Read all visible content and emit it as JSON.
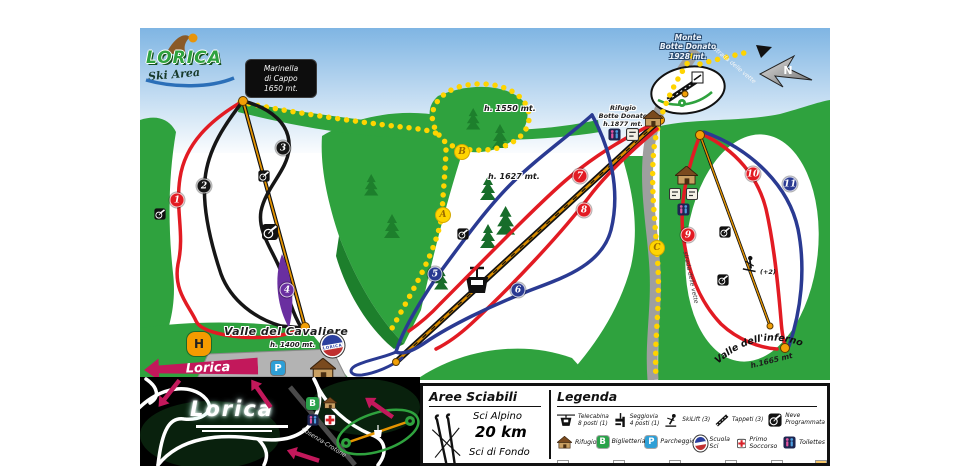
{
  "logo": {
    "name": "LORICA",
    "subtitle": "Ski Area"
  },
  "signs": {
    "marinella": {
      "l1": "Marinella",
      "l2": "di Cappo",
      "l3": "1650 mt."
    },
    "monte_botte": {
      "l1": "Monte",
      "l2": "Botte Donato",
      "l3": "1928 mt."
    },
    "rifugio": {
      "l1": "Rifugio",
      "l2": "Botte Donato",
      "l3": "h.1877 mt."
    },
    "e1550": "h. 1550 mt.",
    "e1627": "h. 1627 mt.",
    "cavaliere": "Valle del Cavaliere",
    "cavaliere_elev": "h. 1400 mt.",
    "inferno": "Valle dell'inferno",
    "inferno_elev": "h.1665 mt",
    "road": "strada delle vette",
    "compass_n": "N",
    "lorica_arrow": "Lorica",
    "parking": "P",
    "heli": "H",
    "skier_note": "(+2)",
    "school_badge": "LORICA"
  },
  "runs": [
    {
      "number": "1",
      "color": "#e21b23"
    },
    {
      "number": "2",
      "color": "#161616"
    },
    {
      "number": "3",
      "color": "#161616"
    },
    {
      "number": "4",
      "color": "#6a2fa0"
    },
    {
      "number": "5",
      "color": "#2a3a92"
    },
    {
      "number": "6",
      "color": "#2a3a92"
    },
    {
      "number": "7",
      "color": "#e21b23"
    },
    {
      "number": "8",
      "color": "#e21b23"
    },
    {
      "number": "9",
      "color": "#e21b23"
    },
    {
      "number": "10",
      "color": "#e21b23"
    },
    {
      "number": "11",
      "color": "#2a3a92"
    }
  ],
  "markers": [
    {
      "letter": "B"
    },
    {
      "letter": "A"
    },
    {
      "letter": "C"
    }
  ],
  "inset": {
    "town": "Lorica",
    "road_label": "Cosenza-Crotone",
    "ticket": "B"
  },
  "aree": {
    "title": "Aree Sciabili",
    "alpine_label": "Sci Alpino",
    "alpine_km": "20 km",
    "nordic_label": "Sci di Fondo"
  },
  "legend": {
    "title": "Legenda",
    "row1": [
      {
        "l1": "Telecabina",
        "l2": "8 posti (1)"
      },
      {
        "l1": "Seggiovia",
        "l2": "4 posti (1)"
      },
      {
        "l1": "SkiLift (3)",
        "l2": ""
      },
      {
        "l1": "Tappeti (3)",
        "l2": ""
      },
      {
        "l1": "Neve",
        "l2": "Programmata"
      }
    ],
    "row2": [
      {
        "label": "Rifugio"
      },
      {
        "label": "Biglietteria"
      },
      {
        "label": "Parcheggio"
      },
      {
        "label": "Scuola Sci"
      },
      {
        "label": "Primo Soccorso"
      },
      {
        "label": "Toilettes"
      }
    ],
    "ticket_letter": "B",
    "parking_letter": "P"
  },
  "colors": {
    "red_run": "#e21b23",
    "blue_run": "#2a3a92",
    "black_run": "#161616",
    "purple_run": "#6a2fa0",
    "trail_yellow": "#ffd400",
    "arrow_pink": "#c2185b",
    "green": "#2fa23e"
  }
}
